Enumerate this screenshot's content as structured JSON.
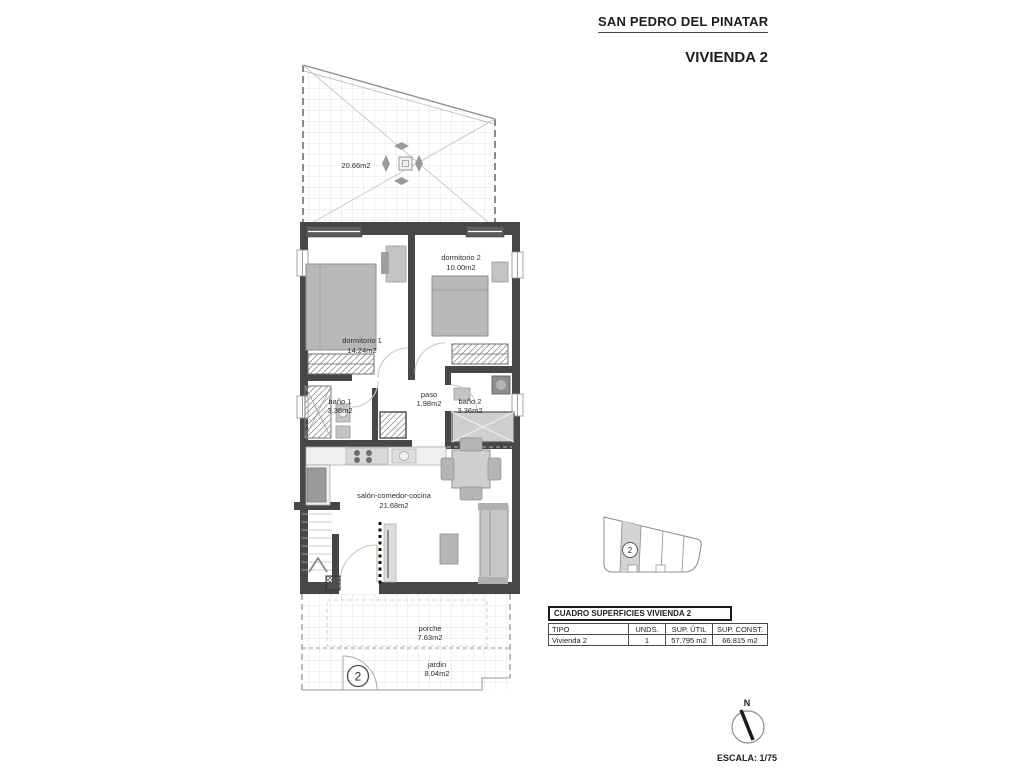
{
  "header": {
    "location": "SAN PEDRO DEL PINATAR",
    "unit_title": "VIVIENDA 2"
  },
  "plan": {
    "rooms": [
      {
        "name": "solarium",
        "label": "",
        "area": "20.66m2"
      },
      {
        "name": "dormitorio-1",
        "label": "dormitorio 1",
        "area": "14.24m2"
      },
      {
        "name": "dormitorio-2",
        "label": "dormitorio 2",
        "area": "10.00m2"
      },
      {
        "name": "bano-1",
        "label": "baño 1",
        "area": "3.36m2"
      },
      {
        "name": "paso",
        "label": "paso",
        "area": "1.98m2"
      },
      {
        "name": "bano-2",
        "label": "baño 2",
        "area": "3.36m2"
      },
      {
        "name": "salon-comedor-cocina",
        "label": "salón-comedor-cocina",
        "area": "21.68m2"
      },
      {
        "name": "porche",
        "label": "porche",
        "area": "7.63m2"
      },
      {
        "name": "jardin",
        "label": "jardin",
        "area": "8.04m2"
      }
    ],
    "unit_marker": "2"
  },
  "site_plan": {
    "highlighted_unit": "2"
  },
  "surfaces_table": {
    "title": "CUADRO SUPERFICIES VIVIENDA 2",
    "columns": [
      "TIPO",
      "UNDS.",
      "SUP. ÚTIL",
      "SUP. CONST."
    ],
    "rows": [
      [
        "Vivienda 2",
        "1",
        "57.795 m2",
        "66.815 m2"
      ]
    ]
  },
  "compass": {
    "north_label": "N"
  },
  "scale_label": "ESCALA: 1/75",
  "colors": {
    "wall": "#474747",
    "window": "#5a5a5a",
    "furniture": "#c0c0c0",
    "grid": "#dcdcdc"
  }
}
